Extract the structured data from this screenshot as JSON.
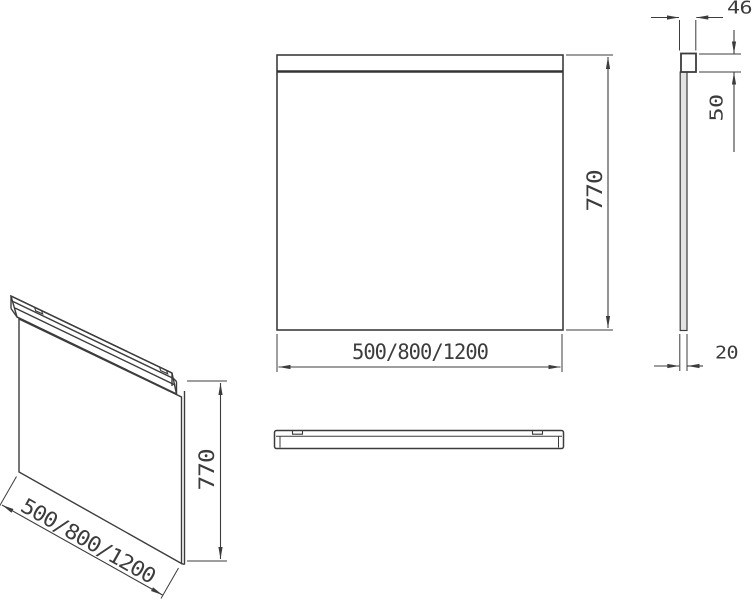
{
  "drawing": {
    "title": "wall-mirror-technical-drawing",
    "front_view": {
      "width_label": "500/800/1200",
      "height_label": "770"
    },
    "side_view": {
      "depth_label": "46",
      "rail_height_label": "50",
      "thickness_label": "20"
    },
    "iso_view": {
      "width_label": "500/800/1200",
      "height_label": "770"
    }
  },
  "colors": {
    "line": "#3c3c3c",
    "background": "#ffffff"
  }
}
